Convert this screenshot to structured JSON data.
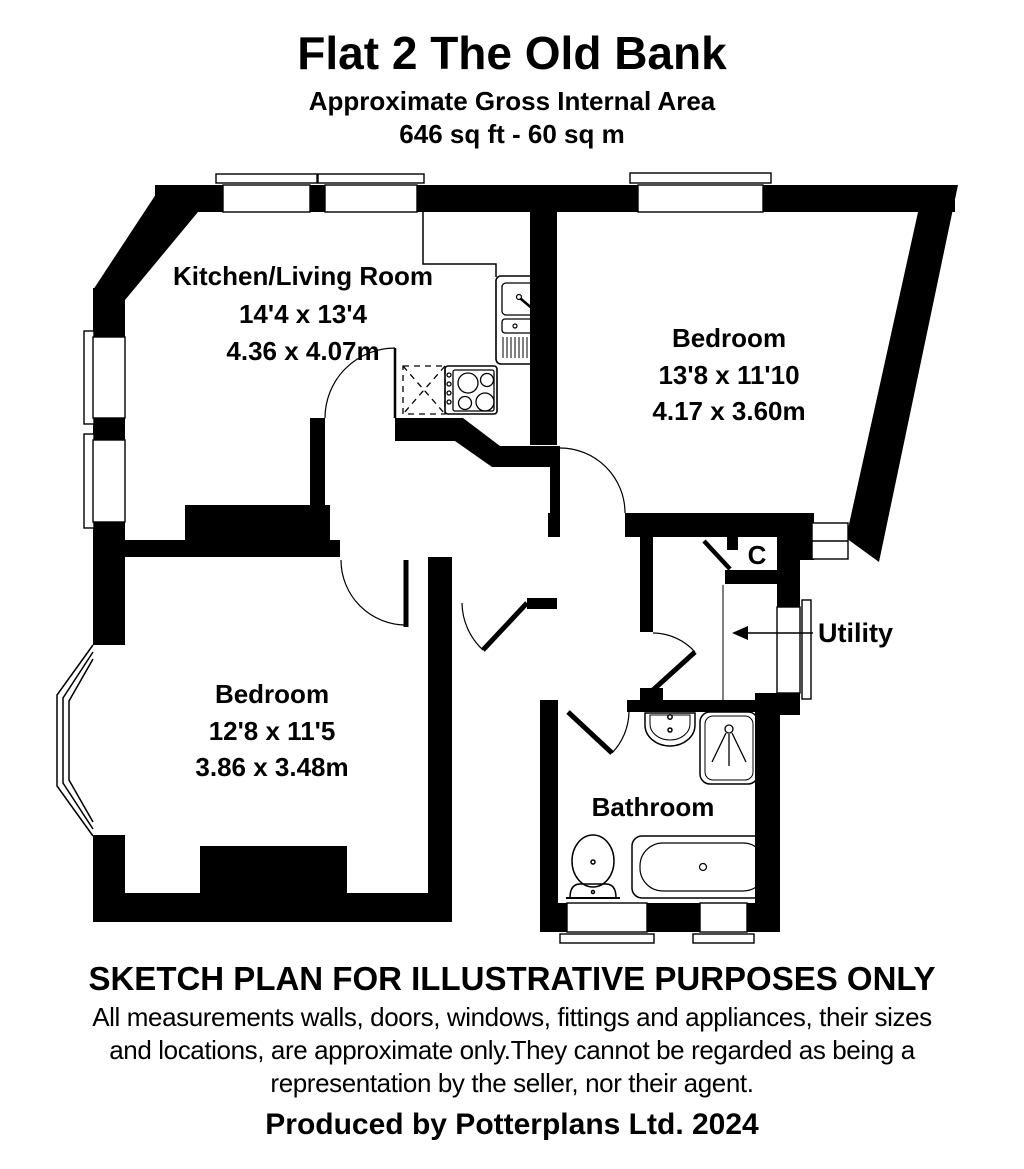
{
  "header": {
    "title": "Flat 2 The Old Bank",
    "subtitle": "Approximate Gross Internal Area",
    "area": "646 sq ft - 60 sq m"
  },
  "rooms": {
    "kitchen_living": {
      "name": "Kitchen/Living Room",
      "size_imperial": "14'4 x 13'4",
      "size_metric": "4.36 x 4.07m"
    },
    "bedroom_right": {
      "name": "Bedroom",
      "size_imperial": "13'8 x 11'10",
      "size_metric": "4.17 x 3.60m"
    },
    "bedroom_left": {
      "name": "Bedroom",
      "size_imperial": "12'8 x 11'5",
      "size_metric": "3.86 x 3.48m"
    },
    "bathroom": {
      "name": "Bathroom"
    },
    "utility": {
      "name": "Utility"
    },
    "cupboard": {
      "name": "C"
    }
  },
  "fixtures": {
    "kitchen": [
      "sink-unit",
      "hob",
      "appliance-space"
    ],
    "bathroom": [
      "toilet",
      "bath",
      "basin",
      "shower"
    ]
  },
  "colors": {
    "walls": "#000000",
    "background": "#ffffff"
  },
  "footer": {
    "heading": "SKETCH PLAN FOR ILLUSTRATIVE PURPOSES ONLY",
    "disclaimer_line1": "All measurements walls, doors, windows, fittings and appliances, their sizes",
    "disclaimer_line2": "and locations, are approximate only.They cannot be regarded as being a",
    "disclaimer_line3": "representation by the seller, nor their agent.",
    "credit": "Produced by Potterplans Ltd. 2024"
  }
}
